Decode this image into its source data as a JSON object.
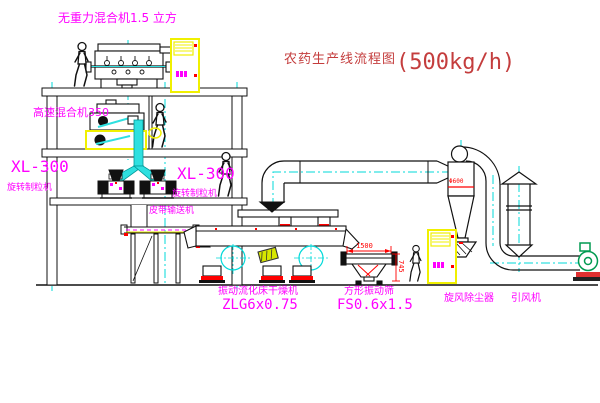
{
  "title": {
    "name": "农药生产线流程图",
    "capacity": "(500kg/h)"
  },
  "labels": {
    "gravity_mixer": "无重力混合机1.5 立方",
    "high_speed_mixer": "高速混合机350",
    "granulator_left_model": "XL-300",
    "granulator_left_name": "旋转制粒机",
    "granulator_right_model": "XL-300",
    "granulator_right_name": "旋转制粒机",
    "belt_conveyor": "皮带输送机",
    "dryer_name": "振动流化床干燥机",
    "dryer_model": "ZLG6x0.75",
    "sieve_name": "方形振动筛",
    "sieve_model": "FS0.6x1.5",
    "cyclone": "旋风除尘器",
    "fan": "引风机"
  },
  "dimensions": {
    "sieve_length": "1500",
    "sieve_height": "745",
    "cyclone_diameter": "Φ600"
  },
  "colors": {
    "line": "#000000",
    "centerline": "#00d9d9",
    "pipe_fill": "#2ee0e0",
    "label": "#ff00ff",
    "dim": "#ff0000",
    "title": "#c43d3d",
    "cabinet": "#f0f000",
    "fan": "#009a50"
  }
}
